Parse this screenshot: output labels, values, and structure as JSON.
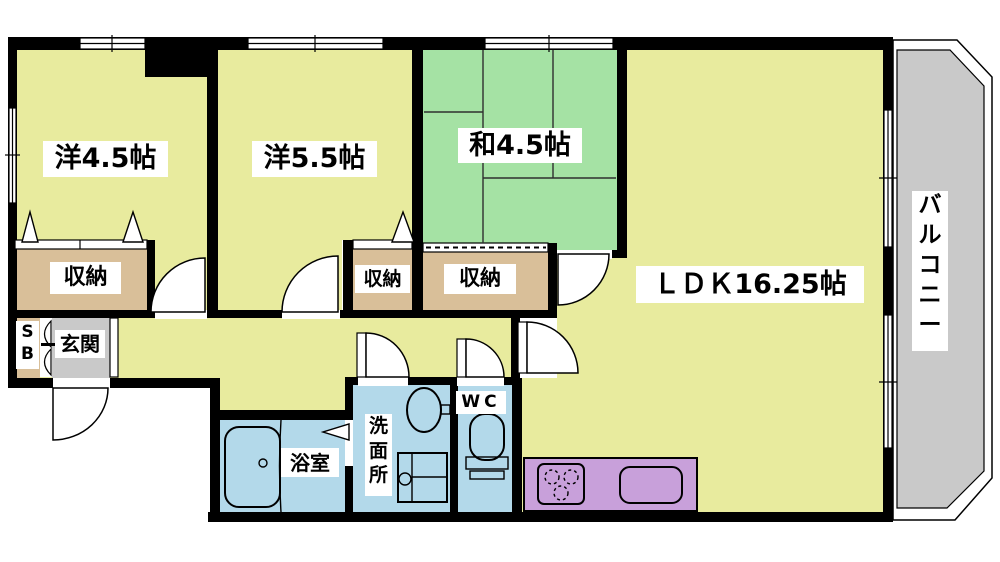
{
  "rooms": {
    "west_room_1": {
      "label": "洋4.5帖"
    },
    "west_room_2": {
      "label": "洋5.5帖"
    },
    "japanese_room": {
      "label": "和4.5帖"
    },
    "ldk": {
      "label": "ＬＤＫ16.25帖"
    },
    "balcony": {
      "label": "バルコニー"
    },
    "storage_1": {
      "label": "収納"
    },
    "storage_2": {
      "label": "収納"
    },
    "storage_3": {
      "label": "収納"
    },
    "shoe_box": {
      "label": "SB"
    },
    "entrance": {
      "label": "玄関"
    },
    "bathroom": {
      "label": "浴室"
    },
    "washroom": {
      "label": "洗面所"
    },
    "toilet": {
      "label": "WC"
    }
  },
  "colors": {
    "wall": "#000000",
    "floor_main": "#e8eb9e",
    "tatami": "#a5e2a4",
    "storage": "#d9bf99",
    "wet_area": "#b3d9ea",
    "kitchen_counter": "#c8a0da",
    "entrance_floor": "#c9c9c9",
    "balcony_deck": "#c9c9c9",
    "label_bg": "#ffffff"
  }
}
